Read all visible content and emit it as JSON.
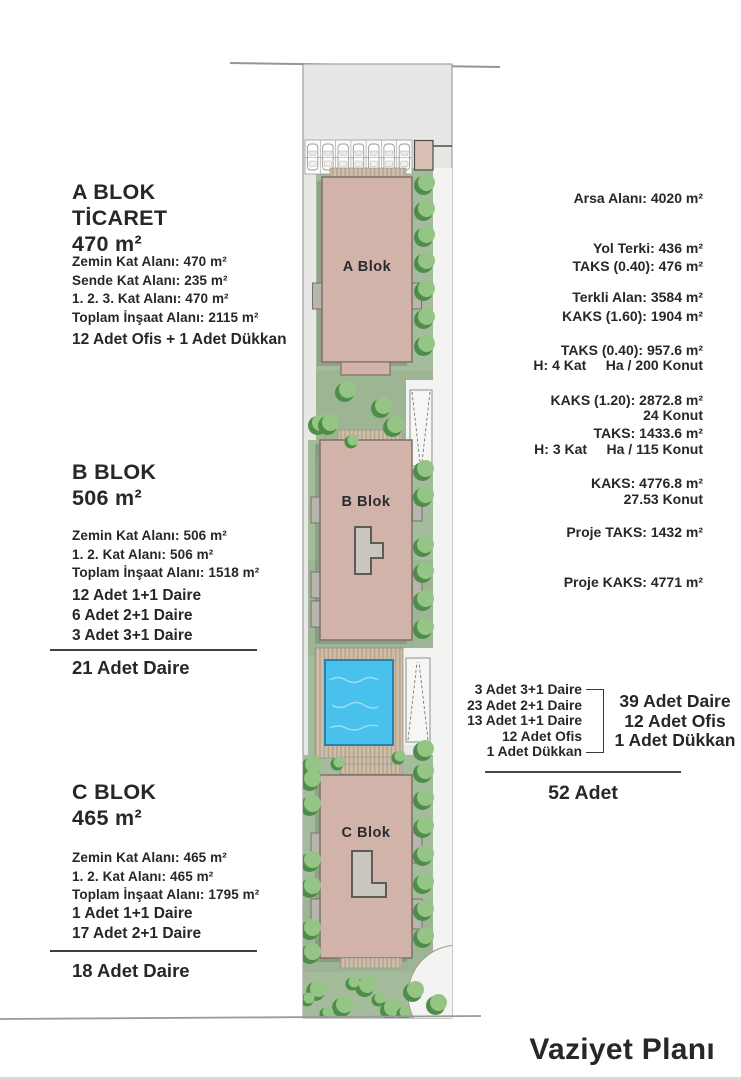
{
  "plan_title": "Vaziyet Planı",
  "blocks": {
    "a": {
      "heading": [
        "A BLOK",
        "TİCARET",
        "470 m²"
      ],
      "details": [
        "Zemin Kat Alanı: 470 m²",
        "Sende Kat Alanı: 235 m²",
        "1. 2. 3. Kat Alanı: 470 m²",
        "Toplam İnşaat Alanı: 2115 m²"
      ],
      "units": [
        "12 Adet Ofis + 1 Adet Dükkan"
      ],
      "map_label": "A Blok"
    },
    "b": {
      "heading": [
        "B BLOK",
        "506 m²"
      ],
      "details": [
        "Zemin Kat Alanı: 506 m²",
        "1. 2. Kat Alanı: 506 m²",
        "Toplam İnşaat Alanı: 1518 m²"
      ],
      "units": [
        "12 Adet 1+1 Daire",
        "6 Adet 2+1 Daire",
        "3 Adet 3+1 Daire"
      ],
      "total": "21 Adet Daire",
      "map_label": "B Blok"
    },
    "c": {
      "heading": [
        "C BLOK",
        "465 m²"
      ],
      "details": [
        "Zemin Kat Alanı: 465 m²",
        "1. 2. Kat Alanı: 465 m²",
        "Toplam İnşaat Alanı: 1795 m²"
      ],
      "units": [
        "1 Adet 1+1 Daire",
        "17 Adet 2+1 Daire"
      ],
      "total": "18 Adet Daire",
      "map_label": "C Blok"
    }
  },
  "zoning": {
    "area": [
      "Arsa Alanı: 4020 m²",
      "Yol Terki: 436 m²",
      "Terkli Alan: 3584 m²"
    ],
    "plan_a": [
      "TAKS (0.40): 476 m²",
      "KAKS (1.60): 1904 m²",
      "H: 4 Kat     Ha / 200 Konut",
      "24 Konut"
    ],
    "plan_b": [
      "TAKS (0.40): 957.6 m²",
      "KAKS (1.20): 2872.8 m²",
      "H: 3 Kat     Ha / 115 Konut",
      "27.53 Konut"
    ],
    "totals": [
      "TAKS: 1433.6 m²",
      "KAKS: 4776.8 m²",
      "Proje TAKS: 1432 m²",
      "Proje KAKS: 4771 m²"
    ]
  },
  "summary": {
    "breakdown": [
      "3 Adet 3+1 Daire",
      "23 Adet 2+1 Daire",
      "13 Adet 1+1 Daire",
      "12 Adet Ofis",
      "1 Adet Dükkan"
    ],
    "totals": [
      "39 Adet Daire",
      "12 Adet Ofis",
      "1 Adet Dükkan"
    ],
    "grand_total": "52 Adet"
  },
  "colors": {
    "building": "#d2b3aa",
    "courtyard": "#c9c5bf",
    "lawn": "#a5bc9c",
    "tree_light": "#94c584",
    "tree_dark": "#4e8c4a",
    "pool": "#48c1ec",
    "deck": "#cfbea9",
    "parcel": "#e7e7e5",
    "path": "#f3f3f1",
    "text": "#27272b"
  }
}
